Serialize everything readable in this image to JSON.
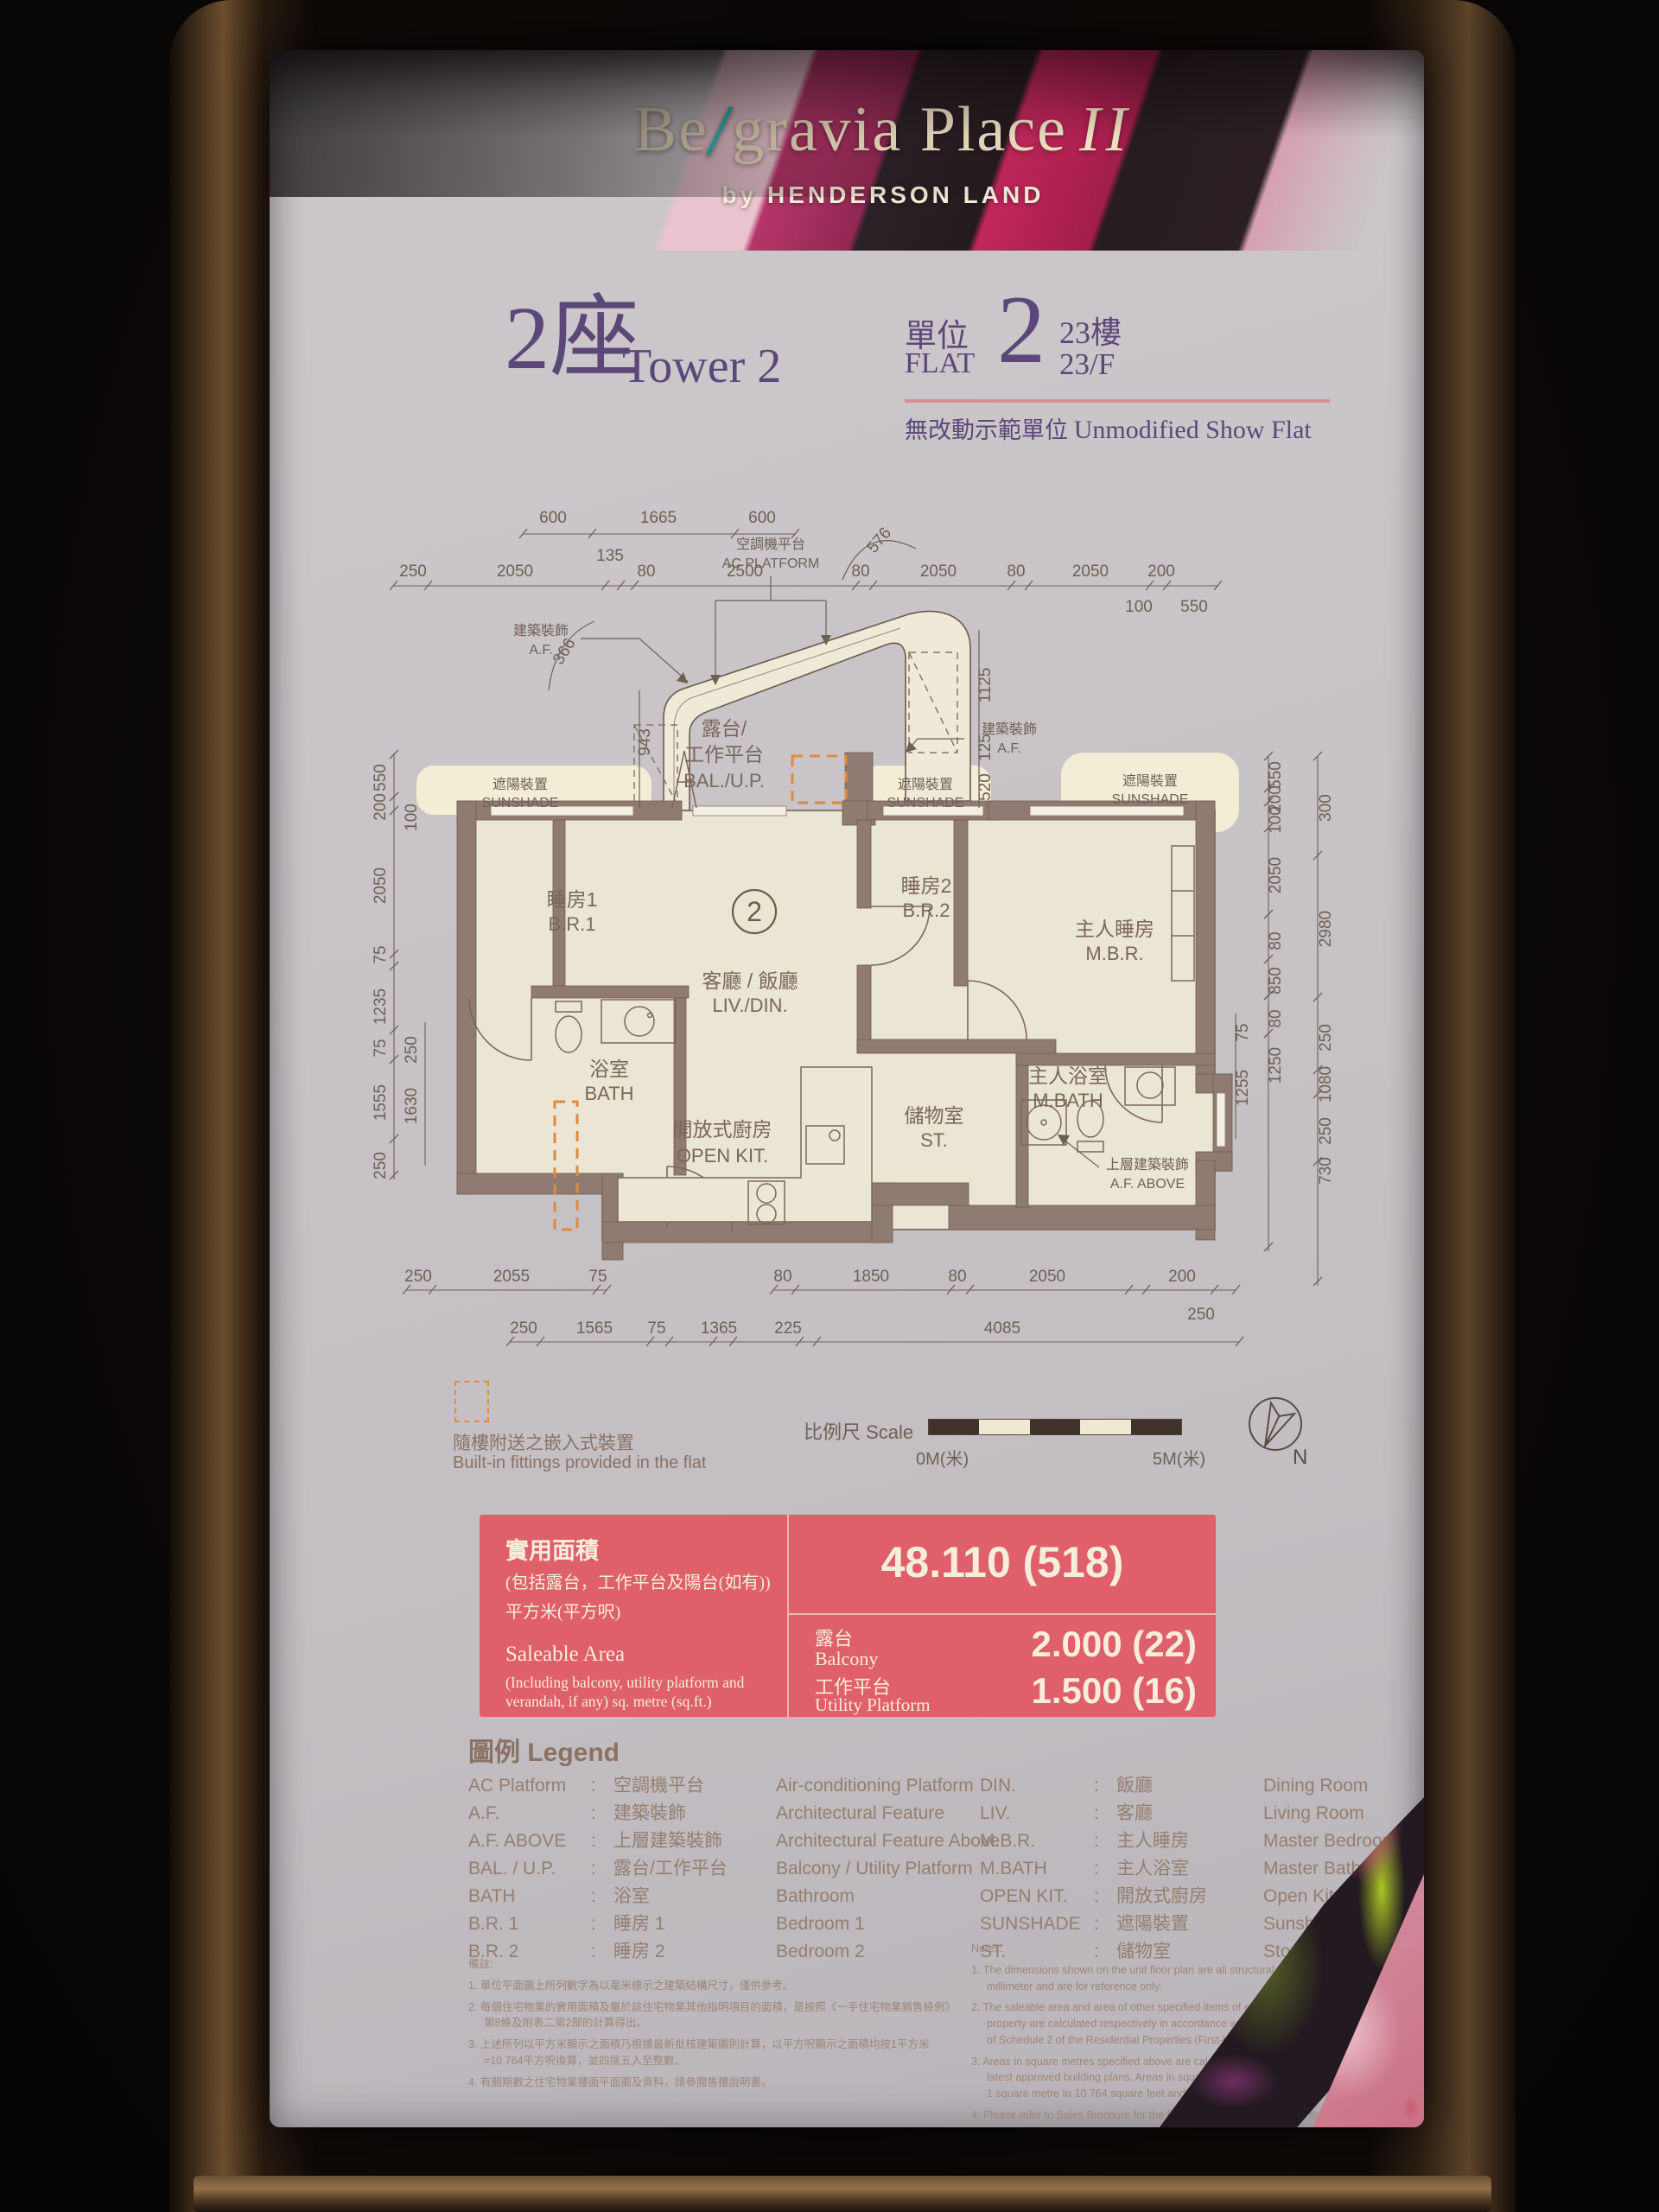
{
  "brand": {
    "pre": "Be",
    "slash": "/",
    "mid": "gravia Place",
    "suffix": "II",
    "byline": "by HENDERSON LAND"
  },
  "unit": {
    "tower_cn": "2座",
    "tower_en": "Tower 2",
    "flat_label_cn": "單位",
    "flat_label_en": "FLAT",
    "flat_no": "2",
    "floor_cn": "23樓",
    "floor_en": "23/F",
    "showflat_cn": "無改動示範單位",
    "showflat_en": "Unmodified Show Flat"
  },
  "plan": {
    "unit_marker": "2",
    "rooms": {
      "br1_cn": "睡房1",
      "br1_en": "B.R.1",
      "bath_cn": "浴室",
      "bath_en": "BATH",
      "liv_cn": "客廳 / 飯廳",
      "liv_en": "LIV./DIN.",
      "br2_cn": "睡房2",
      "br2_en": "B.R.2",
      "mbr_cn": "主人睡房",
      "mbr_en": "M.B.R.",
      "kit_cn": "開放式廚房",
      "kit_en": "OPEN KIT.",
      "st_cn": "儲物室",
      "st_en": "ST.",
      "mbath_cn": "主人浴室",
      "mbath_en": "M.BATH",
      "bal_cn1": "露台/",
      "bal_cn2": "工作平台",
      "bal_en": "BAL./U.P."
    },
    "labels": {
      "ac_cn": "空調機平台",
      "ac_en": "AC PLATFORM",
      "af_cn": "建築裝飾",
      "af_en": "A.F.",
      "af_above_cn": "上層建築裝飾",
      "af_above_en": "A.F. ABOVE",
      "sunshade_cn": "遮陽裝置",
      "sunshade_en": "SUNSHADE"
    },
    "dims": {
      "top1": [
        "600",
        "1665",
        "600"
      ],
      "top2": [
        "250",
        "2050",
        "135",
        "80",
        "2500",
        "80",
        "2050",
        "80",
        "2050",
        "200"
      ],
      "top2b": [
        "100",
        "550"
      ],
      "bal": [
        "576",
        "366",
        "943",
        "1125",
        "125",
        "520"
      ],
      "left_outer": [
        "550",
        "200",
        "2050",
        "75",
        "1235",
        "75",
        "1555",
        "250"
      ],
      "left_inner": [
        "100",
        "250",
        "1630"
      ],
      "right_inner": [
        "550",
        "200",
        "100",
        "2050",
        "80",
        "850",
        "80",
        "1250"
      ],
      "right_outer": [
        "300",
        "2980",
        "250",
        "1080",
        "250",
        "730"
      ],
      "right_in2": [
        "75",
        "1255"
      ],
      "bottom1": [
        "250",
        "2055",
        "75",
        "80",
        "1850",
        "80",
        "2050",
        "200"
      ],
      "bottom1b": [
        "250"
      ],
      "bottom2": [
        "250",
        "1565",
        "75",
        "1365",
        "225",
        "4085"
      ]
    }
  },
  "footer": {
    "fittings_cn": "隨樓附送之嵌入式裝置",
    "fittings_en": "Built-in fittings provided in the flat",
    "scale_label": "比例尺 Scale",
    "scale_zero": "0M(米)",
    "scale_five": "5M(米)",
    "north": "N"
  },
  "area": {
    "cn_title": "實用面積",
    "cn_sub": "(包括露台，工作平台及陽台(如有))",
    "cn_unit": "平方米(平方呎)",
    "en_title": "Saleable Area",
    "en_sub": "(Including balcony, utility platform and verandah, if any) sq. metre (sq.ft.)",
    "total": "48.110 (518)",
    "balcony_cn": "露台",
    "balcony_en": "Balcony",
    "balcony_val": "2.000 (22)",
    "up_cn": "工作平台",
    "up_en": "Utility Platform",
    "up_val": "1.500 (16)"
  },
  "legend": {
    "title": "圖例 Legend",
    "colon": ":",
    "left": [
      {
        "abbr": "AC Platform",
        "cn": "空調機平台",
        "en": "Air-conditioning Platform"
      },
      {
        "abbr": "A.F.",
        "cn": "建築裝飾",
        "en": "Architectural Feature"
      },
      {
        "abbr": "A.F. ABOVE",
        "cn": "上層建築裝飾",
        "en": "Architectural Feature Above"
      },
      {
        "abbr": "BAL. / U.P.",
        "cn": "露台/工作平台",
        "en": "Balcony / Utility Platform"
      },
      {
        "abbr": "BATH",
        "cn": "浴室",
        "en": "Bathroom"
      },
      {
        "abbr": "B.R. 1",
        "cn": "睡房 1",
        "en": "Bedroom 1"
      },
      {
        "abbr": "B.R. 2",
        "cn": "睡房 2",
        "en": "Bedroom 2"
      }
    ],
    "right": [
      {
        "abbr": "DIN.",
        "cn": "飯廳",
        "en": "Dining Room"
      },
      {
        "abbr": "LIV.",
        "cn": "客廳",
        "en": "Living Room"
      },
      {
        "abbr": "M.B.R.",
        "cn": "主人睡房",
        "en": "Master Bedroom"
      },
      {
        "abbr": "M.BATH",
        "cn": "主人浴室",
        "en": "Master Bathroom"
      },
      {
        "abbr": "OPEN KIT.",
        "cn": "開放式廚房",
        "en": "Open Kitchen"
      },
      {
        "abbr": "SUNSHADE",
        "cn": "遮陽裝置",
        "en": "Sunshading Device"
      },
      {
        "abbr": "ST.",
        "cn": "儲物室",
        "en": "Store Room"
      }
    ]
  },
  "notes": {
    "cn_header": "備註:",
    "cn_items": [
      "1. 單位平面圖上所列數字為以毫米標示之建築結構尺寸，僅供參考。",
      "2. 每個住宅物業的實用面積及屬於該住宅物業其他指明項目的面積，是按照《一手住宅物業銷售條例》第8條及附表二第2部的計算得出。",
      "3. 上述所列以平方米顯示之面積乃根據最新批核建築圖則計算，以平方呎顯示之面積均按1平方米=10.764平方呎換算，並四捨五入至整數。",
      "4. 有關期數之住宅物業樓面平面圖及資料，請參閱售樓說明書。"
    ],
    "en_header": "Notes:",
    "en_items": [
      "1. The dimensions shown on the unit floor plan are all structural dimensions in millimeter and are for reference only.",
      "2. The saleable area and area of other specified items of each residential property are calculated respectively in accordance with Section 8 and Part 2 of Schedule 2 of the Residential Properties (First-hand Sales) Ordinance.",
      "3. Areas in square metres specified above are calculated in accordance with the latest approved building plans. Areas in square feet are converted at a rate of 1 square metre to 10.764 square feet and rounded to the nearest integer.",
      "4. Please refer to Sales Brochure for the floor plans and information of the residential properties in the Phase."
    ]
  }
}
